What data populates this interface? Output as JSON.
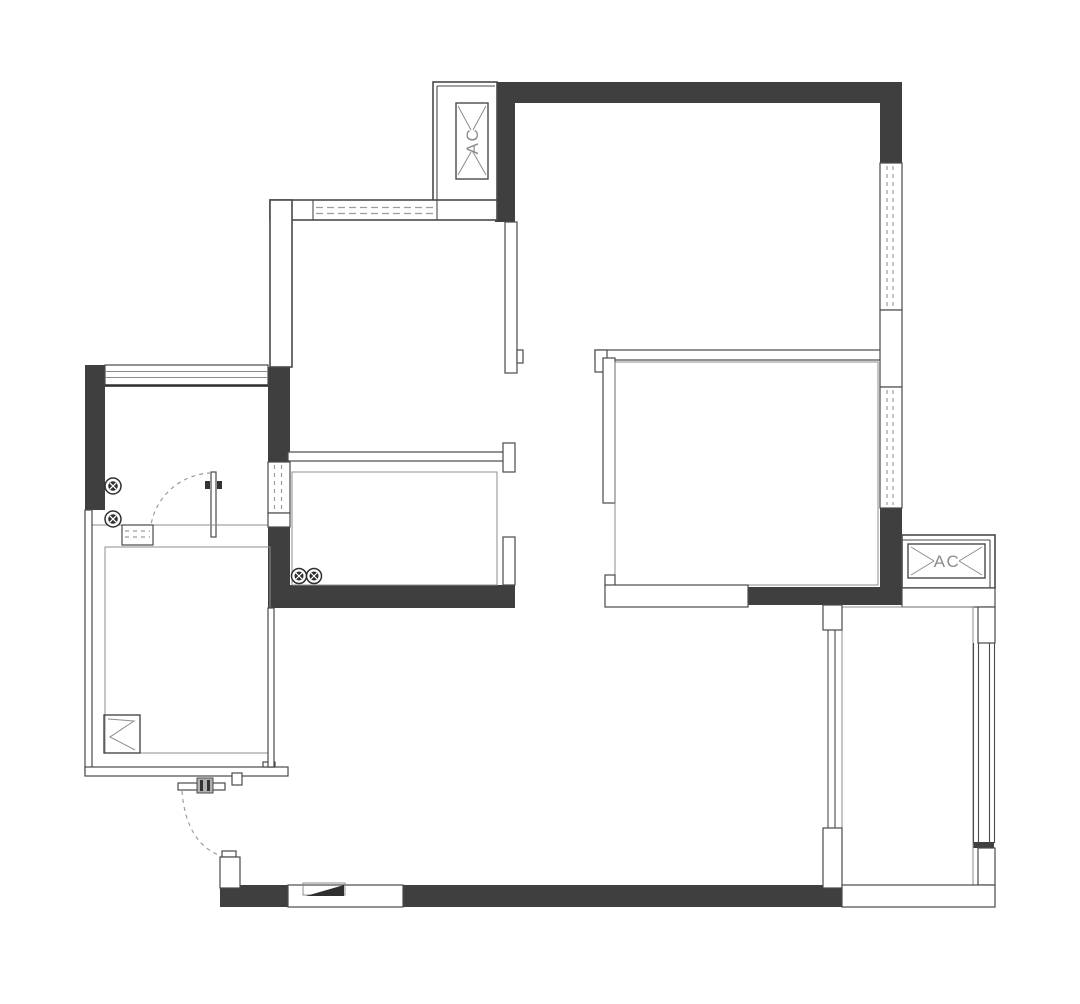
{
  "title": "apartment-floor-plan",
  "colors": {
    "background": "#ffffff",
    "wall_dark": "#3f3f3f",
    "wall_outline": "#4a4a4a",
    "thin_line": "#8c8c8c",
    "dashed_line": "#9c9c9c",
    "label_text": "#8c8c8c"
  },
  "labels": {
    "ac_unit_top": "AC",
    "ac_unit_right": "AC"
  },
  "symbols": {
    "ac_units": 2,
    "pipe_riser_symbols": 4,
    "door_swings": 2,
    "window_openings": 7
  }
}
